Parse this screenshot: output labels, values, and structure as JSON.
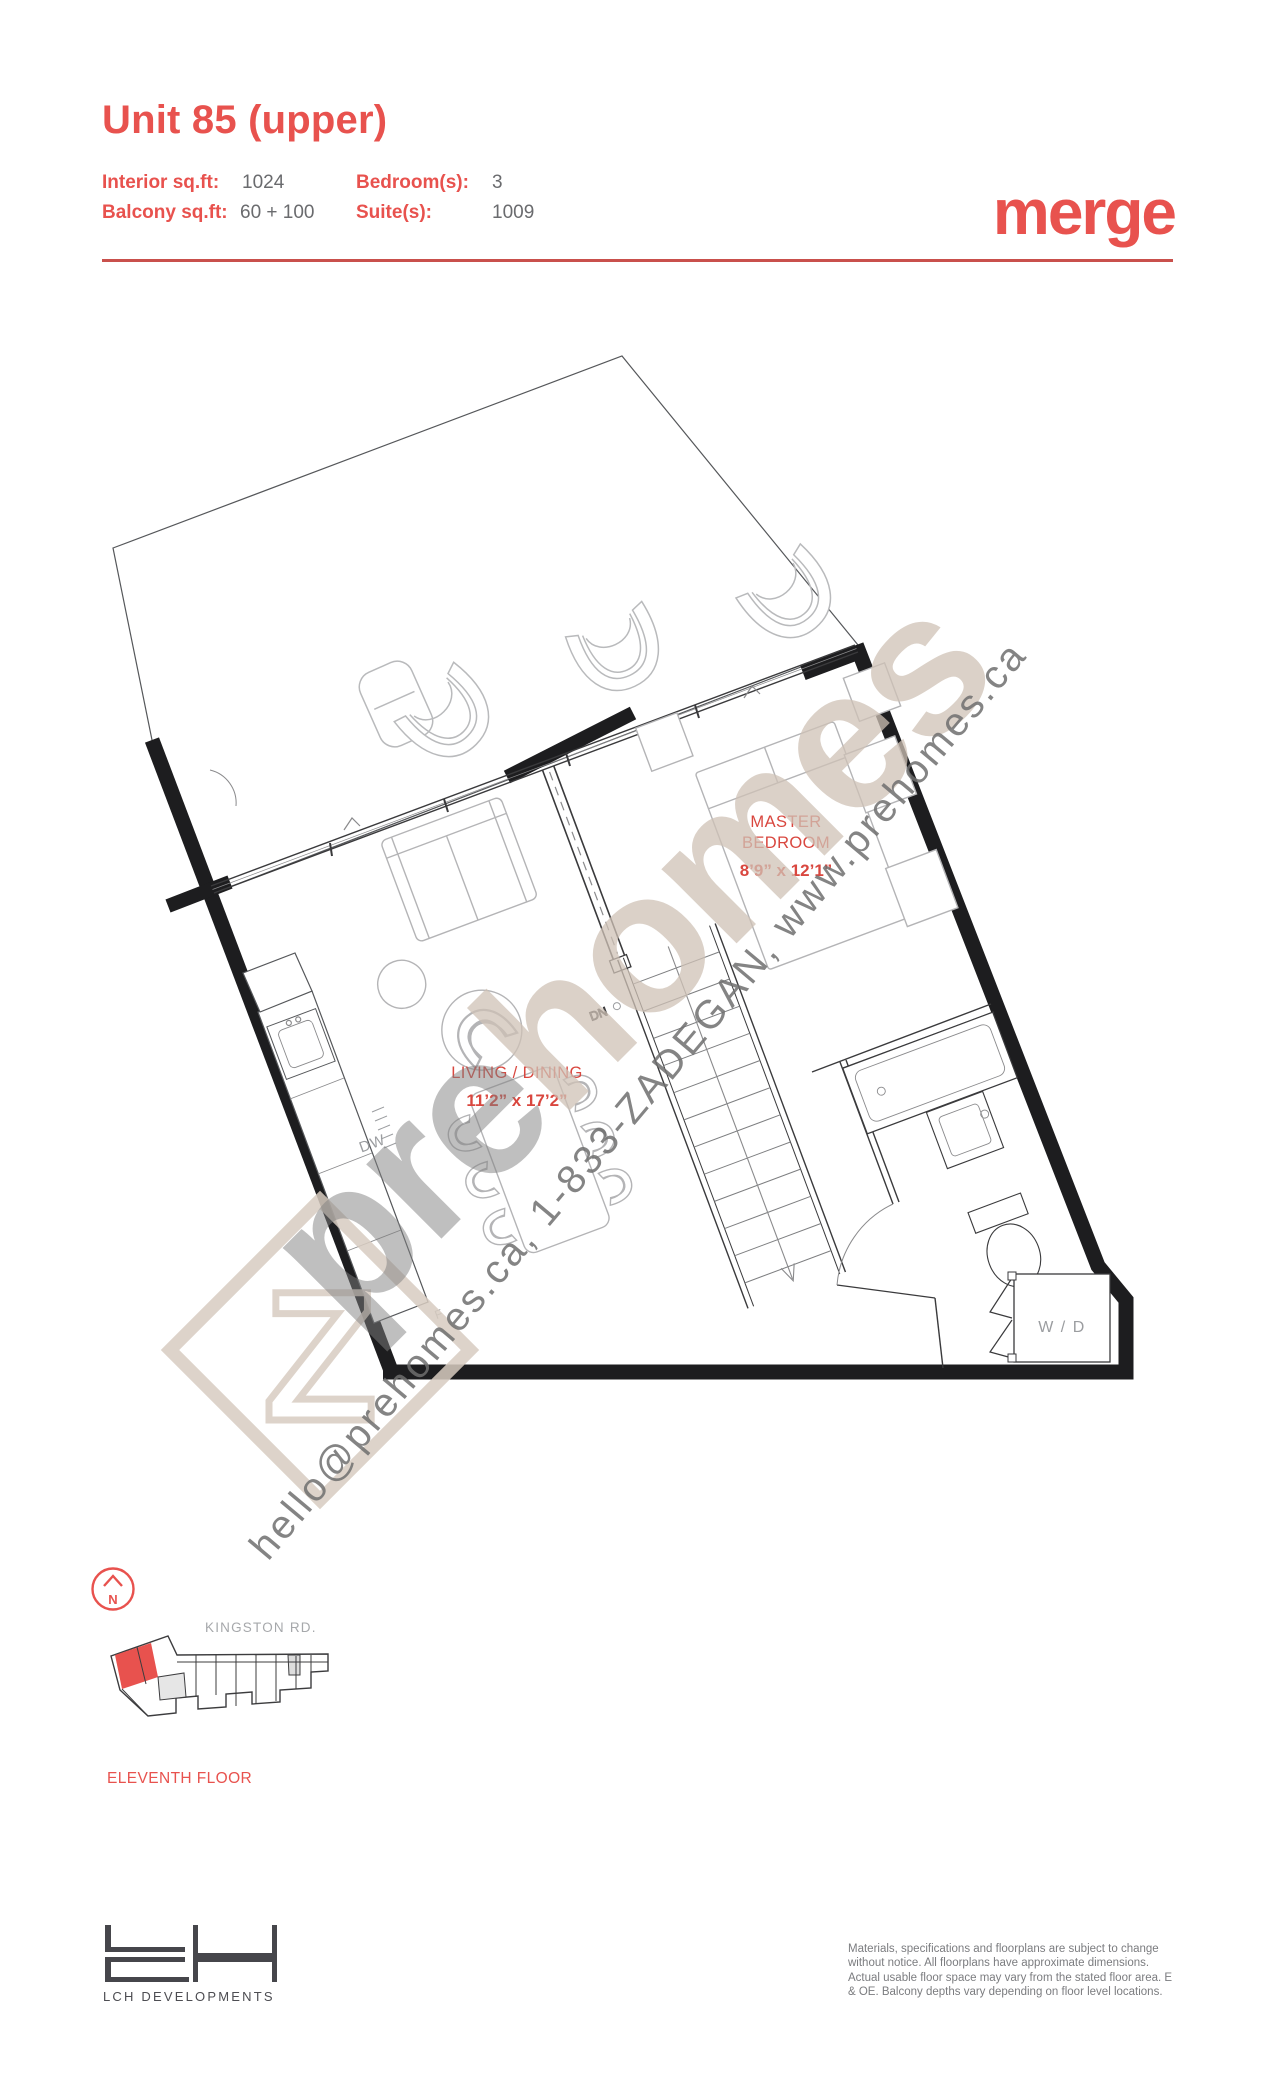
{
  "header": {
    "title": "Unit 85 (upper)",
    "brand": "merge",
    "specs": [
      {
        "label": "Interior sq.ft:",
        "value": "1024"
      },
      {
        "label": "Bedroom(s):",
        "value": "3"
      },
      {
        "label": "Balcony sq.ft:",
        "value": "60 + 100"
      },
      {
        "label": "Suite(s):",
        "value": "1009"
      }
    ],
    "accent_color": "#e8524e"
  },
  "floorplan": {
    "rooms": [
      {
        "line1": "MASTER",
        "line2": "BEDROOM",
        "dims": "8’9” x 12’1”"
      },
      {
        "line1": "LIVING / DINING",
        "dims": "11’2” x 17’2”"
      }
    ],
    "labels": {
      "dn": "DN",
      "dw": "DW",
      "wd": "W / D",
      "f": "F"
    }
  },
  "watermark": {
    "pre": "pre",
    "homes": "homes",
    "z": "Z",
    "contact": "hello@prehomes.ca, 1-833-ZADEGAN, www.prehomes.ca"
  },
  "locator": {
    "north": "N",
    "street": "KINGSTON RD.",
    "floor": "ELEVENTH FLOOR"
  },
  "footer": {
    "developer": "LCH DEVELOPMENTS",
    "disclaimer": "Materials, specifications and floorplans are subject to change without notice. All floorplans have approximate dimensions. Actual usable floor space may vary from the stated floor area. E & OE. Balcony depths vary depending on floor level locations."
  }
}
